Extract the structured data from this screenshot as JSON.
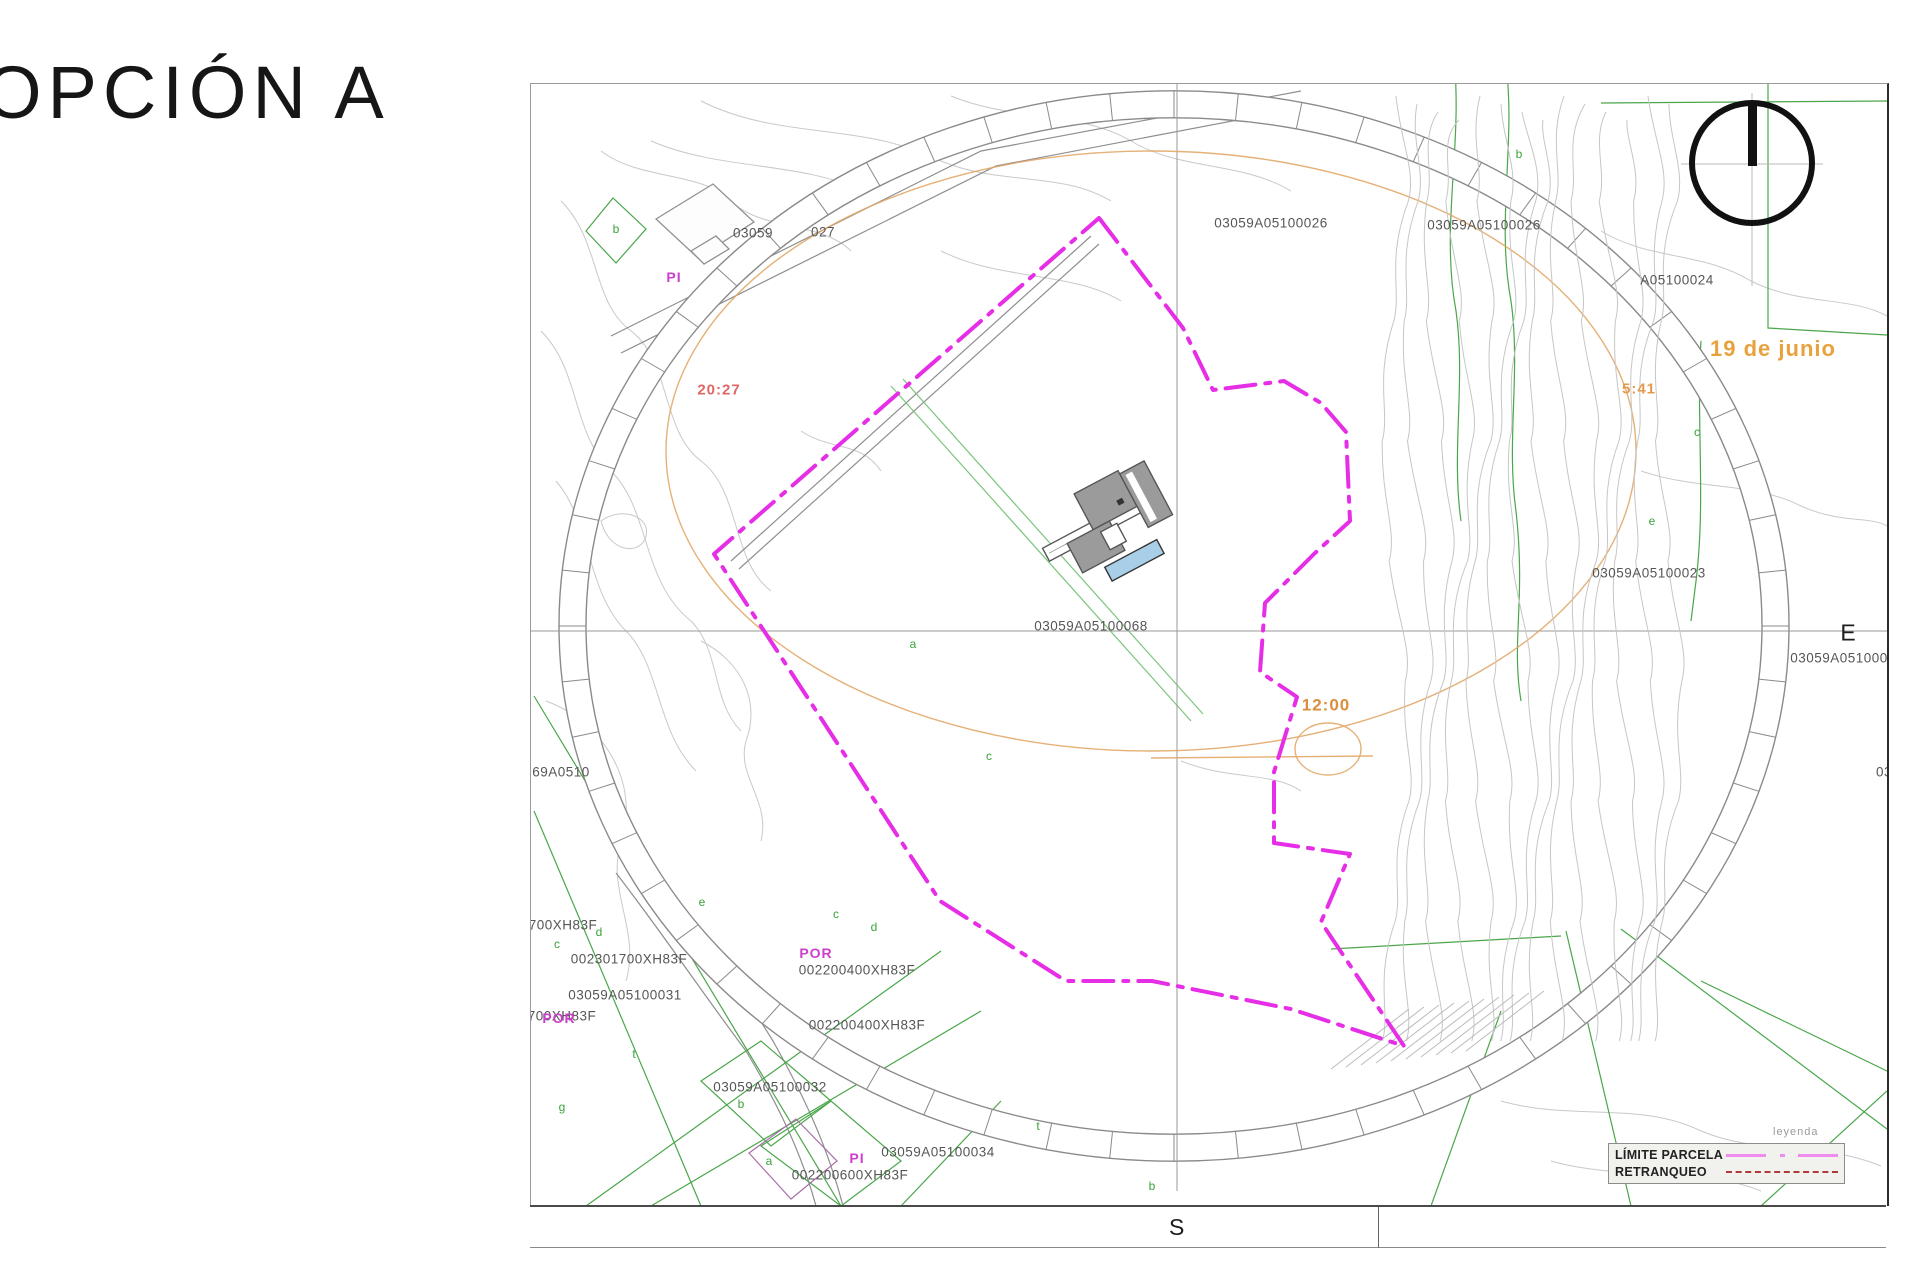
{
  "title": "OPCIÓN A",
  "map": {
    "east_label": "E",
    "south_label": "S",
    "sun_annotations": [
      {
        "text": "20:27",
        "x": 718,
        "y": 389,
        "color": "#e06666",
        "size": 15
      },
      {
        "text": "5:41",
        "x": 1638,
        "y": 388,
        "color": "#e39a4d",
        "size": 15
      },
      {
        "text": "12:00",
        "x": 1325,
        "y": 704,
        "color": "#d98f3e",
        "size": 17
      },
      {
        "text": "19 de junio",
        "x": 1772,
        "y": 348,
        "color": "#e8a23c",
        "size": 22
      }
    ],
    "cadastral_labels": [
      {
        "text": "03059",
        "x": 752,
        "y": 232
      },
      {
        "text": "027",
        "x": 822,
        "y": 231
      },
      {
        "text": "03059A05100026",
        "x": 1270,
        "y": 222
      },
      {
        "text": "03059A05100026",
        "x": 1483,
        "y": 224
      },
      {
        "text": "A05100024",
        "x": 1676,
        "y": 279
      },
      {
        "text": "03059A05100023",
        "x": 1648,
        "y": 572
      },
      {
        "text": "03059A05100022",
        "x": 1846,
        "y": 657
      },
      {
        "text": "03059A05100068",
        "x": 1090,
        "y": 625
      },
      {
        "text": "69A0510",
        "x": 560,
        "y": 771
      },
      {
        "text": "700XH83F",
        "x": 562,
        "y": 924
      },
      {
        "text": "002301700XH83F",
        "x": 628,
        "y": 958
      },
      {
        "text": "03059A05100031",
        "x": 624,
        "y": 994
      },
      {
        "text": "700XH83F",
        "x": 561,
        "y": 1015
      },
      {
        "text": "002200400XH83F",
        "x": 856,
        "y": 969
      },
      {
        "text": "002200400XH83F",
        "x": 866,
        "y": 1024
      },
      {
        "text": "03059A05100032",
        "x": 769,
        "y": 1086
      },
      {
        "text": "03059A05100034",
        "x": 937,
        "y": 1151
      },
      {
        "text": "002200600XH83F",
        "x": 849,
        "y": 1174
      },
      {
        "text": "03",
        "x": 1883,
        "y": 771
      }
    ],
    "zone_labels": [
      {
        "text": "PI",
        "x": 673,
        "y": 276
      },
      {
        "text": "POR",
        "x": 815,
        "y": 952
      },
      {
        "text": "POR",
        "x": 558,
        "y": 1017
      },
      {
        "text": "PI",
        "x": 856,
        "y": 1157
      }
    ],
    "letter_labels": [
      {
        "text": "b",
        "x": 615,
        "y": 228
      },
      {
        "text": "c",
        "x": 556,
        "y": 943
      },
      {
        "text": "d",
        "x": 598,
        "y": 931
      },
      {
        "text": "e",
        "x": 701,
        "y": 901
      },
      {
        "text": "c",
        "x": 835,
        "y": 913
      },
      {
        "text": "d",
        "x": 873,
        "y": 926
      },
      {
        "text": "t",
        "x": 633,
        "y": 1053
      },
      {
        "text": "a",
        "x": 912,
        "y": 643
      },
      {
        "text": "g",
        "x": 561,
        "y": 1106
      },
      {
        "text": "b",
        "x": 740,
        "y": 1103
      },
      {
        "text": "a",
        "x": 768,
        "y": 1160
      },
      {
        "text": "b",
        "x": 1518,
        "y": 153
      },
      {
        "text": "c",
        "x": 1696,
        "y": 431
      },
      {
        "text": "e",
        "x": 1651,
        "y": 520
      },
      {
        "text": "t",
        "x": 1037,
        "y": 1125
      },
      {
        "text": "b",
        "x": 1151,
        "y": 1185
      },
      {
        "text": "c",
        "x": 988,
        "y": 755
      }
    ]
  },
  "legend": {
    "title": "leyenda",
    "items": [
      {
        "label": "LÍMITE PARCELA"
      },
      {
        "label": "RETRANQUEO"
      }
    ]
  },
  "colors": {
    "parcel_boundary_magenta": "#e52ee5",
    "legend_limite_sample": "#ee8dee",
    "retranqueo_dark_red": "#b03a3a",
    "cadastral_green": "#4aa64a",
    "sun_path_orange": "#e0a35f",
    "sunset_time_red": "#e06666",
    "contour_gray": "#c9c9c9",
    "building_gray": "#9b9b9b",
    "pool_blue": "#a9cfe8"
  }
}
